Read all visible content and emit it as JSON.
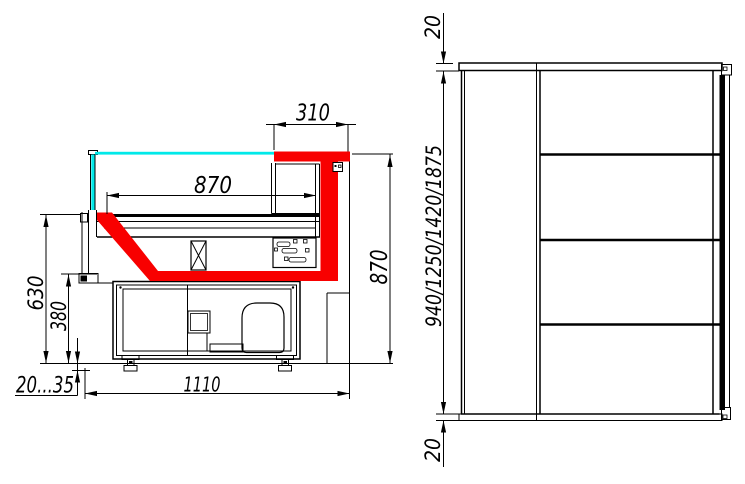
{
  "colors": {
    "background": "#ffffff",
    "line": "#000000",
    "accent_red": "#f80000",
    "glass_cyan": "#00e9e9"
  },
  "dimensions": {
    "side_view": {
      "back_overhang_width": "310",
      "deck_depth": "870",
      "overall_height": "870",
      "deck_height": "630",
      "base_height": "380",
      "foot_adjust_range": "20...35",
      "base_depth": "1110"
    },
    "front_view": {
      "top_panel_thickness": "20",
      "height_variants": "940/1250/1420/1875",
      "bottom_panel_thickness": "20"
    }
  }
}
